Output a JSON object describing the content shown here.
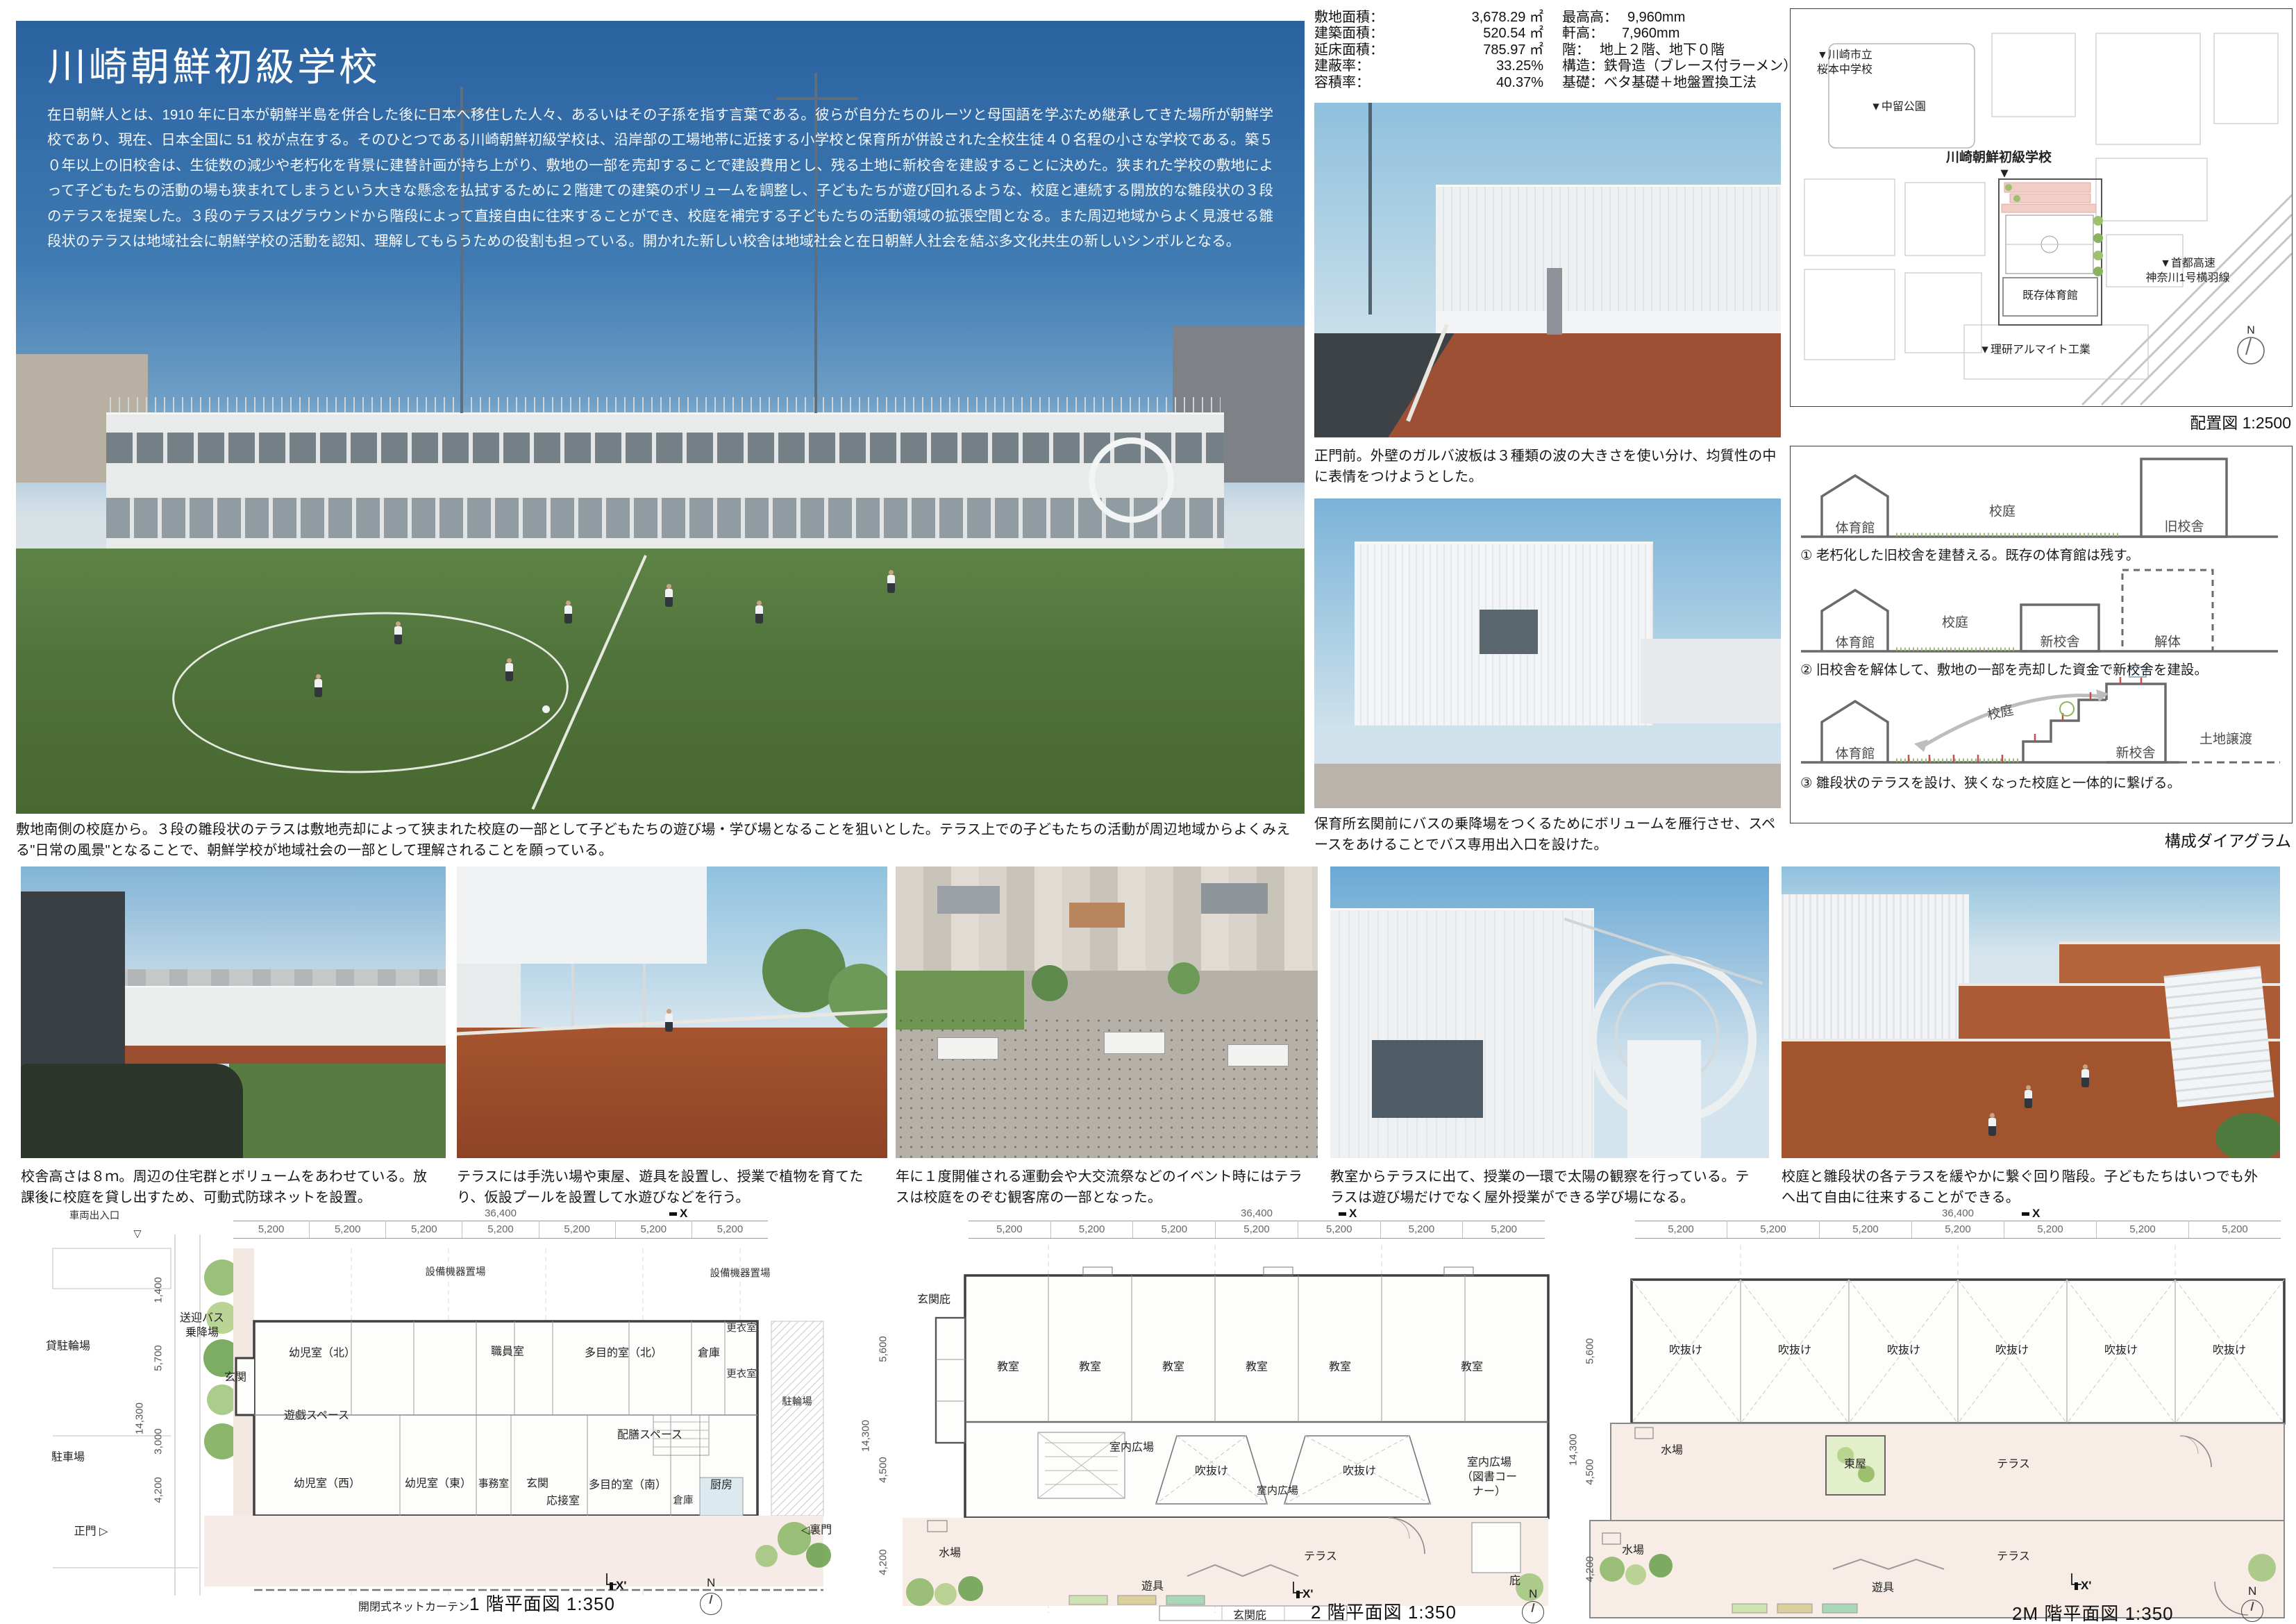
{
  "header": {
    "title": "川崎朝鮮初級学校",
    "intro": "在日朝鮮人とは、1910 年に日本が朝鮮半島を併合した後に日本へ移住した人々、あるいはその子孫を指す言葉である。彼らが自分たちのルーツと母国語を学ぶため継承してきた場所が朝鮮学校であり、現在、日本全国に 51 校が点在する。そのひとつである川崎朝鮮初級学校は、沿岸部の工場地帯に近接する小学校と保育所が併設された全校生徒４０名程の小さな学校である。築５０年以上の旧校舎は、生徒数の減少や老朽化を背景に建替計画が持ち上がり、敷地の一部を売却することで建設費用とし、残る土地に新校舎を建設することに決めた。狭まれた学校の敷地によって子どもたちの活動の場も狭まれてしまうという大きな懸念を払拭するために２階建ての建築のボリュームを調整し、子どもたちが遊び回れるような、校庭と連続する開放的な雛段状の３段のテラスを提案した。３段のテラスはグラウンドから階段によって直接自由に往来することができ、校庭を補完する子どもたちの活動領域の拡張空間となる。また周辺地域からよく見渡せる雛段状のテラスは地域社会に朝鮮学校の活動を認知、理解してもらうための役割も担っている。開かれた新しい校舎は地域社会と在日朝鮮人社会を結ぶ多文化共生の新しいシンボルとなる。"
  },
  "specs": {
    "left": [
      {
        "label": "敷地面積：",
        "value": "3,678.29 ㎡"
      },
      {
        "label": "建築面積：",
        "value": "520.54 ㎡"
      },
      {
        "label": "延床面積：",
        "value": "785.97 ㎡"
      },
      {
        "label": "建蔽率：",
        "value": "33.25%"
      },
      {
        "label": "容積率：",
        "value": "40.37%"
      }
    ],
    "right": [
      {
        "label": "最高高：",
        "value": "9,960mm"
      },
      {
        "label": "軒高：",
        "value": "7,960mm"
      },
      {
        "label": "階：",
        "value": "地上２階、地下０階"
      },
      {
        "label": "構造：",
        "value": "鉄骨造（ブレース付ラーメン）"
      },
      {
        "label": "基礎：",
        "value": "ベタ基礎＋地盤置換工法"
      }
    ]
  },
  "captions": {
    "main": "敷地南側の校庭から。３段の雛段状のテラスは敷地売却によって狭まれた校庭の一部として子どもたちの遊び場・学び場となることを狙いとした。テラス上での子どもたちの活動が周辺地域からよくみえる\"日常の風景\"となることで、朝鮮学校が地域社会の一部として理解されることを願っている。",
    "gate": "正門前。外壁のガルバ波板は３種類の波の大きさを使い分け、均質性の中に表情をつけようとした。",
    "bus": "保育所玄関前にバスの乗降場をつくるためにボリュームを雁行させ、スペースをあけることでバス専用出入口を設けた。",
    "row2": [
      "校舎高さは８ｍ。周辺の住宅群とボリュームをあわせている。放課後に校庭を貸し出すため、可動式防球ネットを設置。",
      "テラスには手洗い場や東屋、遊具を設置し、授業で植物を育てたり、仮設プールを設置して水遊びなどを行う。",
      "年に１度開催される運動会や大交流祭などのイベント時にはテラスは校庭をのぞむ観客席の一部となった。",
      "教室からテラスに出て、授業の一環で太陽の観察を行っている。テラスは遊び場だけでなく屋外授業ができる学び場になる。",
      "校庭と雛段状の各テラスを緩やかに繋ぐ回り階段。子どもたちはいつでも外へ出て自由に往来することができる。"
    ]
  },
  "map": {
    "labels": {
      "middle_school": "▼川崎市立\n桜本中学校",
      "park": "▼中留公園",
      "site": "川崎朝鮮初級学校",
      "site_arrow": "▼",
      "gym": "既存体育館",
      "highway": "▼首都高速\n神奈川1号横羽線",
      "factory": "▼理研アルマイト工業",
      "north": "N"
    },
    "caption": "配置図 1:2500"
  },
  "diagram": {
    "labels": {
      "gym": "体育館",
      "yard": "校庭",
      "old_school": "旧校舎",
      "new_school": "新校舎",
      "demolition": "解体",
      "land_transfer": "土地譲渡"
    },
    "steps": [
      "① 老朽化した旧校舎を建替える。既存の体育館は残す。",
      "② 旧校舎を解体して、敷地の一部を売却した資金で新校舎を建設。",
      "③ 雛段状のテラスを設け、狭くなった校庭と一体的に繋げる。"
    ],
    "caption": "構成ダイアグラム"
  },
  "plans": {
    "p1": {
      "title": "1 階平面図 1:350",
      "dims": {
        "total": "36,400",
        "bay": "5,200",
        "v1": "1,400",
        "v2": "5,700",
        "vt": "14,300",
        "v3": "3,000",
        "v4": "4,200"
      },
      "marks": {
        "x": "X",
        "x2": "X'",
        "n": "N",
        "vehicle": "車両出入口",
        "vehicle_tri": "▽",
        "gate": "正門 ▷",
        "back_gate": "◁裏門"
      },
      "rooms": {
        "bicycle_rental": "貸駐輪場",
        "parking": "駐車場",
        "bus": "送迎バス\n乗降場",
        "entrance1": "玄関",
        "infant_n": "幼児室（北）",
        "equip": "設備機器置場",
        "staff": "職員室",
        "multi_n": "多目的室（北）",
        "storage": "倉庫",
        "locker": "更衣室",
        "play": "遊戯スペース",
        "catering": "配膳スペース",
        "bike": "駐輪場",
        "infant_w": "幼児室（西）",
        "infant_e": "幼児室（東）",
        "office": "事務室",
        "entrance2": "玄関",
        "reception": "応接室",
        "multi_s": "多目的室（南）",
        "kitchen": "厨房",
        "net": "開閉式ネットカーテン"
      }
    },
    "p2": {
      "title": "2 階平面図 1:350",
      "dims": {
        "total": "36,400",
        "bay": "5,200",
        "v1": "5,600",
        "vt": "14,300",
        "v2": "4,500",
        "v3": "4,200"
      },
      "marks": {
        "x": "X",
        "x2": "X'",
        "n": "N"
      },
      "rooms": {
        "canopy": "玄関庇",
        "classroom": "教室",
        "plaza": "室内広場",
        "void": "吹抜け",
        "plaza_lib": "室内広場\n（図書コーナー）",
        "water": "水場",
        "terrace": "テラス",
        "play": "遊具",
        "eaves": "庇"
      }
    },
    "p3": {
      "title": "2M 階平面図 1:350",
      "dims": {
        "total": "36,400",
        "bay": "5,200",
        "v1": "5,600",
        "vt": "14,300",
        "v2": "4,500",
        "v3": "4,200"
      },
      "marks": {
        "x": "X",
        "x2": "X'",
        "n": "N"
      },
      "rooms": {
        "void": "吹抜け",
        "water": "水場",
        "azumaya": "東屋",
        "terrace": "テラス",
        "play": "遊具"
      }
    }
  },
  "colors": {
    "sky": "#3f7ab2",
    "field": "#51743c",
    "terrace_red": "#9d5033",
    "plan_pink": "#f6ebe6"
  }
}
